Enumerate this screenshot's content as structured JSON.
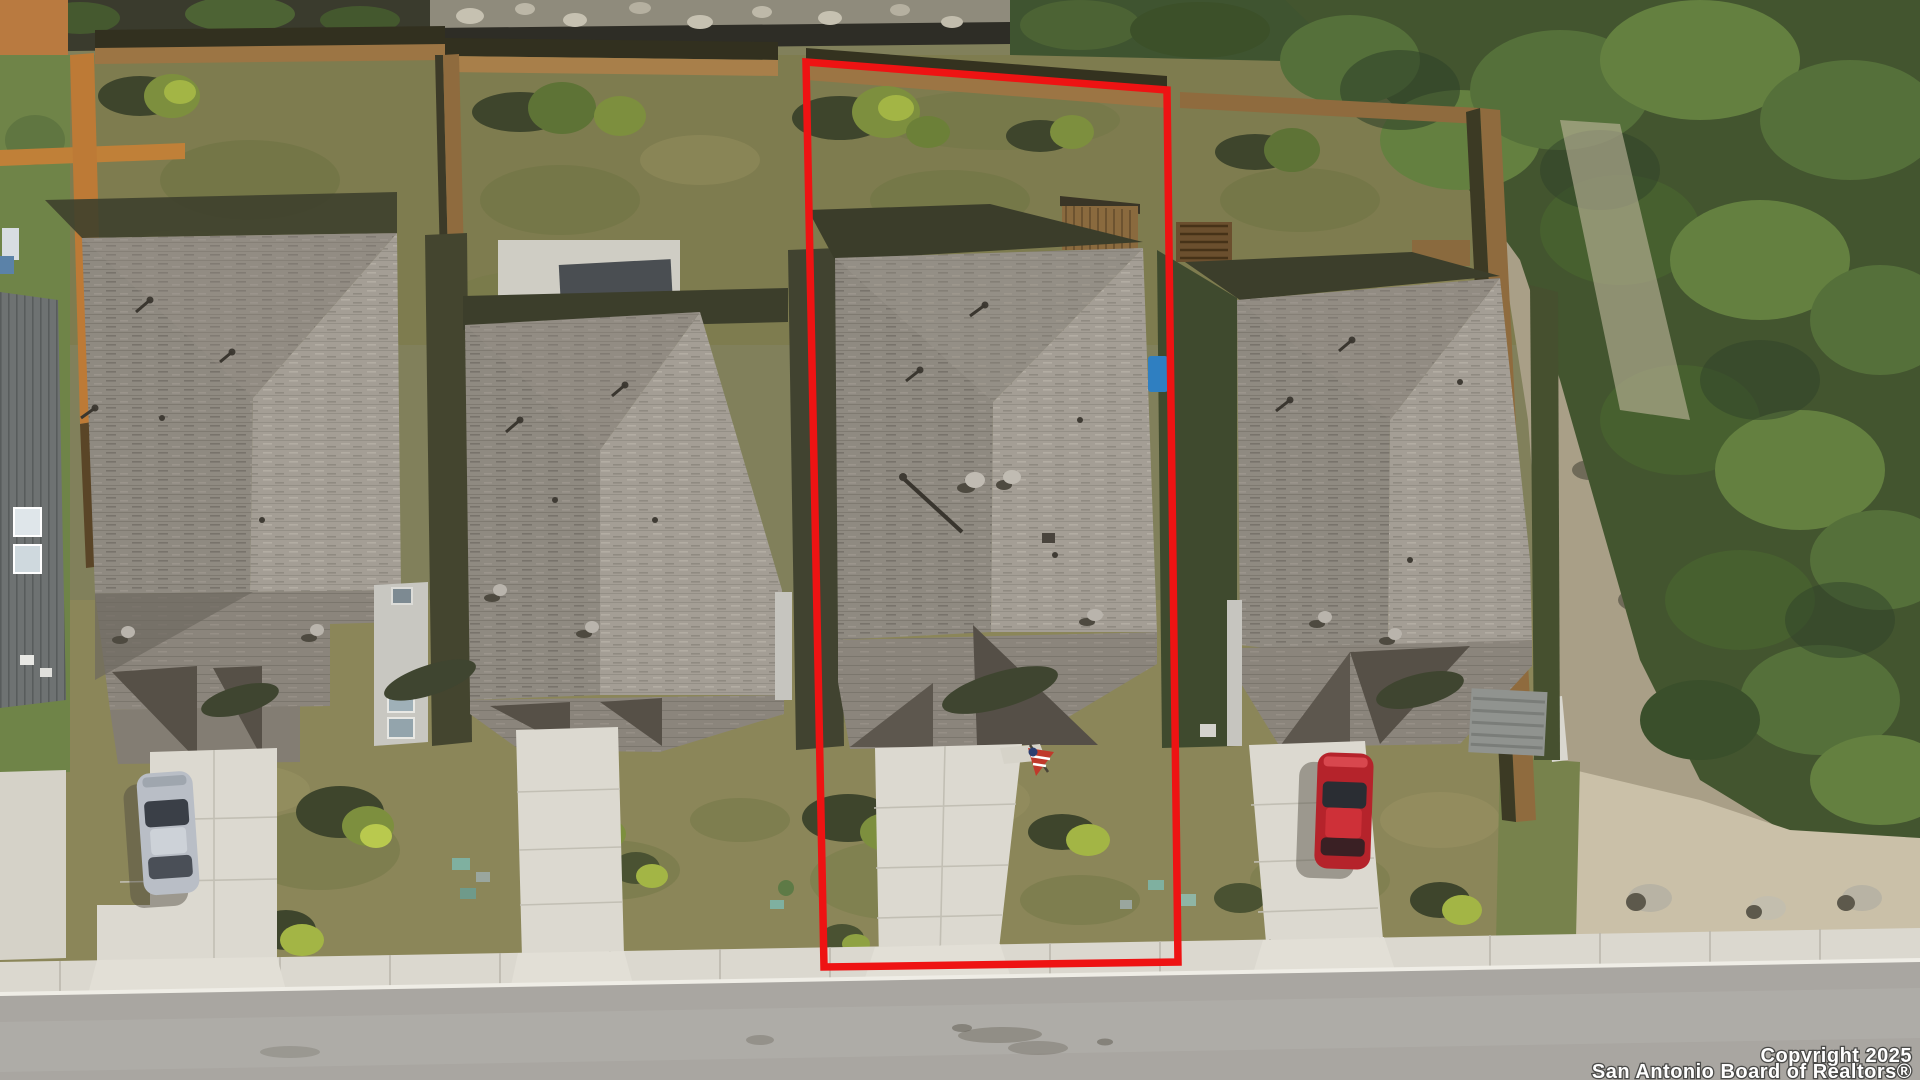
{
  "watermark": {
    "line1": "Copyright 2025",
    "line2": "San Antonio Board of Realtors®"
  },
  "boundary": {
    "points": "806,62 1167,90 1178,962 824,967",
    "color": "#ee1313",
    "description": "red outline highlighting subject lot (third from left)"
  },
  "palette": {
    "grass_base": "#81805b",
    "grass_dark": "#5f6a3c",
    "grass_dry": "#9a9364",
    "roof_light": "#a49e95",
    "roof_mid": "#8f8a81",
    "roof_shadow": "#565047",
    "fence_brown": "#9c7544",
    "fence_orange": "#bd7a36",
    "concrete": "#dcd9d0",
    "street": "#a9a6a1",
    "forest": "#43552f",
    "dirt": "#cac0a8",
    "red_car": "#b5232b",
    "silver_car": "#b9bec6"
  },
  "scene": {
    "type": "aerial-drone-photo",
    "houses_visible": 4,
    "subject_lot_position": "third from left, outlined in red",
    "cars": [
      "silver sedan on far-left driveway",
      "red sedan on right driveway"
    ],
    "features": [
      "backyards with wood privacy fences",
      "rocky greenbelt and dense trees on right",
      "concrete driveways and sidewalk",
      "street across bottom",
      "american flag in subject front yard"
    ]
  }
}
